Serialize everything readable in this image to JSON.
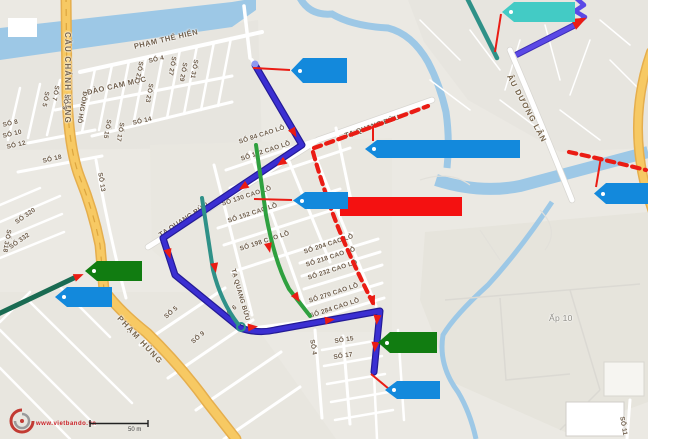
{
  "colors": {
    "route_blue": "#3b2fd2",
    "route_purple": "#5b49e6",
    "route_teal": "#2f9188",
    "route_green": "#2fa03f",
    "route_dark_green": "#1a6b52",
    "route_red": "#ea1c14",
    "tag_blue": "#1389dc",
    "tag_green": "#117c11",
    "tag_cyan": "#43cbc5",
    "tag_white": "#ffffff",
    "highlight_red": "#f41111",
    "water": "#9dc8e6",
    "road_yellow": "#f7c963",
    "road_yellow_edge": "#e5ae4d",
    "label_brown": "#6d5c49",
    "watermark_red": "#cc2229"
  },
  "map": {
    "street_labels": [
      "CẦU CHÁNH HƯNG",
      "PHẠM THẾ HIỂN",
      "ĐÀO CAM MỘC",
      "ĐỒNG HỒ",
      "SỐ 5",
      "SỐ 7",
      "SỐ 9",
      "SỐ 21",
      "SỐ 4",
      "SỐ 27",
      "SỐ 29",
      "SỐ 31",
      "SỐ 23",
      "SỐ 14",
      "SỐ 15",
      "SỐ 17",
      "SỐ 8",
      "SỐ 10",
      "SỐ 12",
      "SỐ 18",
      "SỐ 13",
      "SỐ 320",
      "SỐ 318",
      "SỐ 332",
      "SỐ 84 CAO LỖ",
      "SỐ 102 CAO LỖ",
      "SỐ 130 CAO LỖ",
      "SỐ 152 CAO LỖ",
      "SỐ 198 CAO LỖ",
      "SỐ 204 CAO LỖ",
      "SỐ 218 CAO LỖ",
      "SỐ 232 CAO LỖ",
      "SỐ 270 CAO LỖ",
      "SỐ 284 CAO LỖ",
      "TẠ QUANG BỬU",
      "TẠ QUANG BỬU",
      "TẠ QUANG BỬU",
      "PHẠM HÙNG",
      "SỐ 5",
      "SỐ 9",
      "SỐ 6",
      "SỐ 4",
      "SỐ 15",
      "SỐ 17",
      "ÂU DƯƠNG LÂN",
      "Ấp 10",
      "SỐ 11"
    ],
    "annotations": {
      "tags": [
        {
          "name": "tag-cyan-top",
          "color": "tag_cyan",
          "text": ""
        },
        {
          "name": "tag-blue-top-center",
          "color": "tag_blue",
          "text": ""
        },
        {
          "name": "tag-blue-mid-center",
          "color": "tag_blue",
          "text": ""
        },
        {
          "name": "tag-blue-wide",
          "color": "tag_blue",
          "text": ""
        },
        {
          "name": "tag-blue-right",
          "color": "tag_blue",
          "text": ""
        },
        {
          "name": "tag-blue-left",
          "color": "tag_blue",
          "text": ""
        },
        {
          "name": "tag-blue-bottom",
          "color": "tag_blue",
          "text": ""
        },
        {
          "name": "tag-green-left",
          "color": "tag_green",
          "text": ""
        },
        {
          "name": "tag-green-bottom",
          "color": "tag_green",
          "text": ""
        },
        {
          "name": "blank-label-box",
          "color": "tag_white",
          "text": ""
        },
        {
          "name": "highlight-red-box",
          "color": "highlight_red",
          "text": ""
        }
      ]
    },
    "watermark": {
      "url_text": "www.vietbando.vn"
    },
    "scale": {
      "label": "50 m"
    }
  }
}
